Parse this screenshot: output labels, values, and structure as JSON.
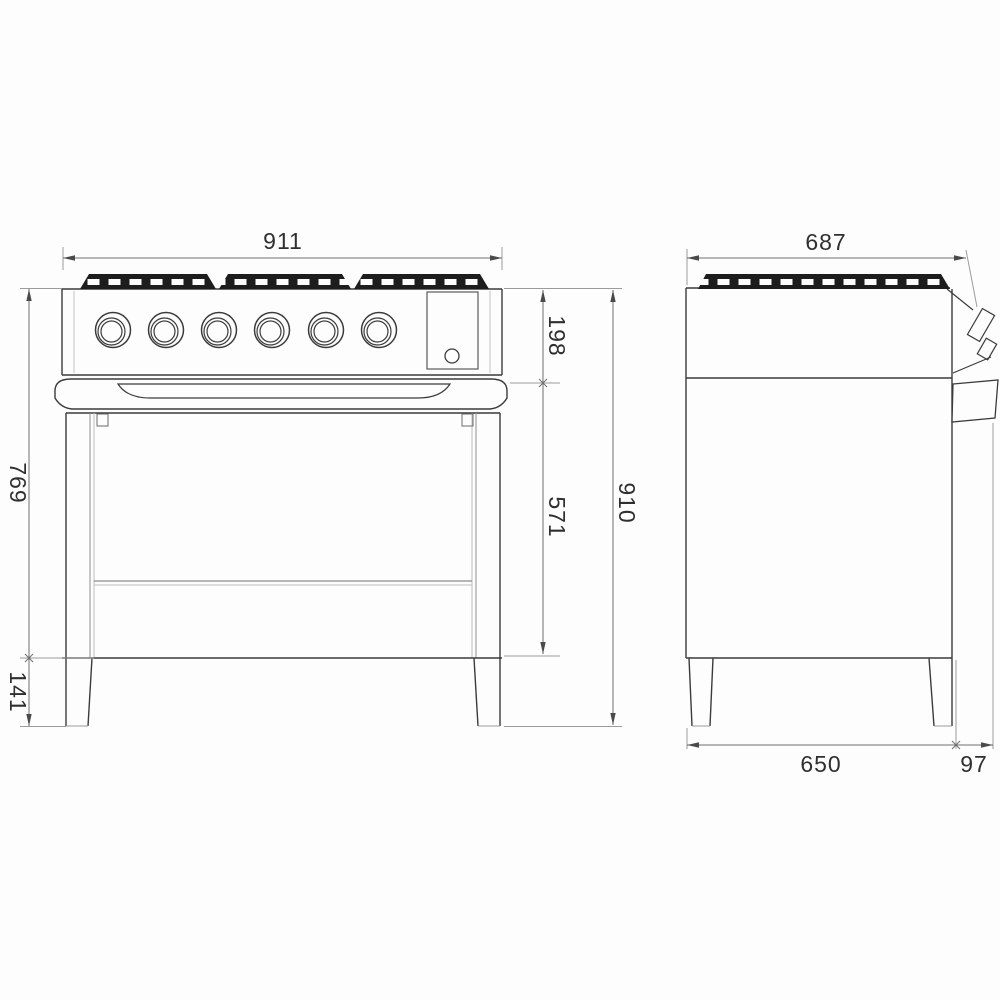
{
  "drawing": {
    "kind": "range-cooker-dimension-diagram",
    "units": "mm",
    "colors": {
      "background": "#fdfdfd",
      "outline": "#3b3b3b",
      "grate_black": "#1d1d1d",
      "dimension_line": "#6e6e6e",
      "text": "#2f2f2f"
    },
    "front_view": {
      "burner_knob_count": 6,
      "grate_section_count": 3,
      "dimensions": {
        "width": "911",
        "control_panel_height": "198",
        "height_above_legs": "769",
        "oven_section_height": "571",
        "total_height": "910",
        "leg_height": "141"
      }
    },
    "side_view": {
      "grate_section_count": 1,
      "dimensions": {
        "total_depth": "687",
        "body_depth": "650",
        "handle_protrusion": "97"
      }
    }
  }
}
